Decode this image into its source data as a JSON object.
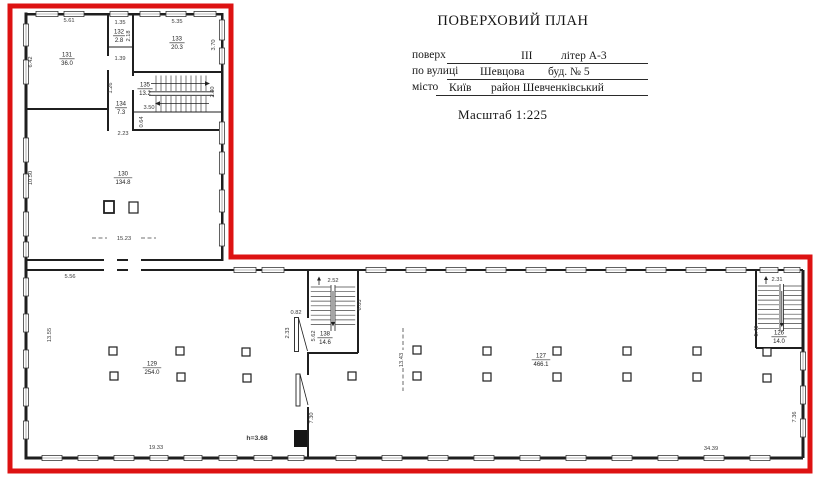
{
  "header": {
    "title": "ПОВЕРХОВИЙ ПЛАН",
    "floor_label": "поверх",
    "floor_value": "III",
    "liter_value": "літер  А-3",
    "street_label": "по вулиці",
    "street_value": "Шевцова",
    "building_value": "буд. №  5",
    "city_label": "місто",
    "city_value": "Київ",
    "district_value": "район Шевченківський",
    "scale": "Масштаб 1:225"
  },
  "plan": {
    "outline_color": "#dd1212",
    "wall_color": "#1f1f1f",
    "room_labels": [
      {
        "num": "131",
        "area": "36.0",
        "x": 67,
        "y": 58
      },
      {
        "num": "132",
        "area": "2.8",
        "x": 119,
        "y": 35
      },
      {
        "num": "133",
        "area": "20.3",
        "x": 177,
        "y": 42
      },
      {
        "num": "134",
        "area": "7.3",
        "x": 121,
        "y": 107
      },
      {
        "num": "135",
        "area": "13.2",
        "x": 145,
        "y": 88
      },
      {
        "num": "130",
        "area": "134.8",
        "x": 123,
        "y": 177
      },
      {
        "num": "129",
        "area": "254.0",
        "x": 152,
        "y": 367
      },
      {
        "num": "138",
        "area": "14.6",
        "x": 325,
        "y": 337
      },
      {
        "num": "127",
        "area": "466.1",
        "x": 541,
        "y": 359
      },
      {
        "num": "126",
        "area": "14.0",
        "x": 779,
        "y": 336
      }
    ],
    "dim_labels": [
      {
        "t": "5.61",
        "x": 69,
        "y": 22
      },
      {
        "t": "6.42",
        "x": 32,
        "y": 62,
        "r": -90
      },
      {
        "t": "1.35",
        "x": 120,
        "y": 24
      },
      {
        "t": "2.18",
        "x": 130,
        "y": 36,
        "r": -90
      },
      {
        "t": "5.35",
        "x": 177,
        "y": 23
      },
      {
        "t": "3.70",
        "x": 215,
        "y": 45,
        "r": -90
      },
      {
        "t": "1.39",
        "x": 120,
        "y": 60
      },
      {
        "t": "1.26",
        "x": 112,
        "y": 88,
        "r": -90
      },
      {
        "t": "3.50",
        "x": 149,
        "y": 109
      },
      {
        "t": "2.40",
        "x": 214,
        "y": 92,
        "r": -90
      },
      {
        "t": "0.64",
        "x": 143,
        "y": 122,
        "r": -90
      },
      {
        "t": "2.23",
        "x": 123,
        "y": 135
      },
      {
        "t": "10.50",
        "x": 32,
        "y": 178,
        "r": -90
      },
      {
        "t": "15.23",
        "x": 124,
        "y": 240
      },
      {
        "t": "5.56",
        "x": 70,
        "y": 278
      },
      {
        "t": "13.55",
        "x": 51,
        "y": 335,
        "r": -90
      },
      {
        "t": "19.33",
        "x": 156,
        "y": 449
      },
      {
        "t": "h=3.68",
        "x": 257,
        "y": 440,
        "b": 1
      },
      {
        "t": "0.82",
        "x": 296,
        "y": 314
      },
      {
        "t": "2.33",
        "x": 289,
        "y": 333,
        "r": -90
      },
      {
        "t": "5.62",
        "x": 315,
        "y": 336,
        "r": -90
      },
      {
        "t": "2.52",
        "x": 333,
        "y": 282
      },
      {
        "t": "6.03",
        "x": 361,
        "y": 305,
        "r": -90
      },
      {
        "t": "7.30",
        "x": 313,
        "y": 418,
        "r": -90
      },
      {
        "t": "13.43",
        "x": 403,
        "y": 360,
        "r": -90
      },
      {
        "t": "34.39",
        "x": 711,
        "y": 450
      },
      {
        "t": "2.31",
        "x": 777,
        "y": 281
      },
      {
        "t": "5.49",
        "x": 758,
        "y": 331,
        "r": -90
      },
      {
        "t": "7.36",
        "x": 796,
        "y": 417,
        "r": -90
      }
    ]
  }
}
